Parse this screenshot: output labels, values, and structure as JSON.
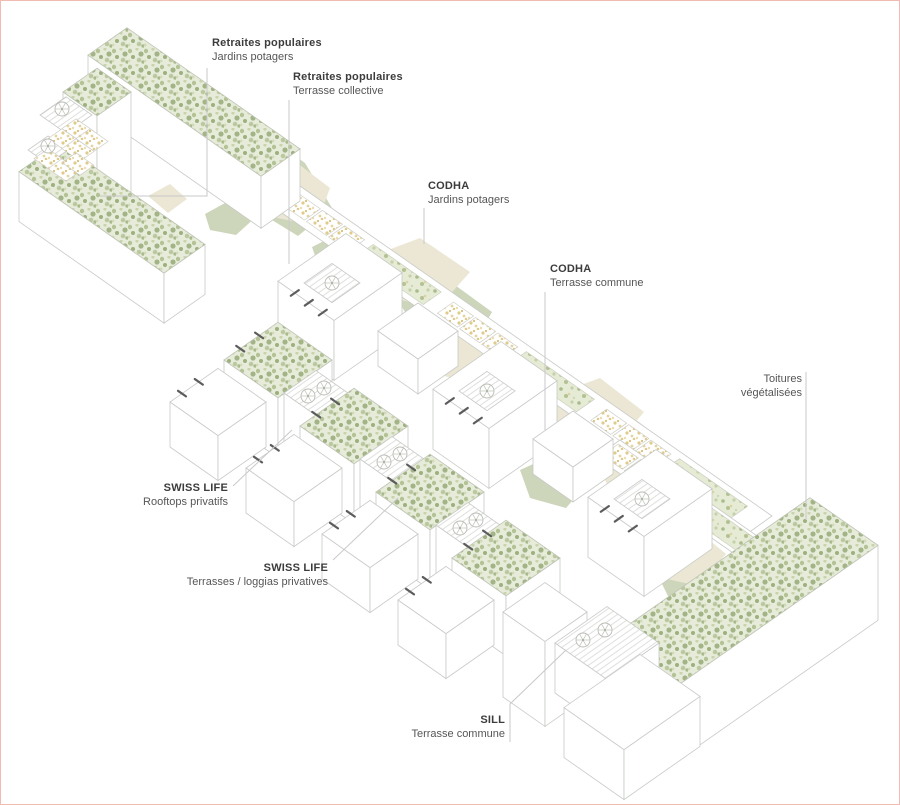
{
  "window": {
    "width": 900,
    "height": 805,
    "background": "#ffffff",
    "frame_border_color": "#f1bbb1"
  },
  "diagram": {
    "type": "axonometric-architecture-roofscape",
    "labels": {
      "retraites_jardins": {
        "title": "Retraites populaires",
        "subtitle": "Jardins potagers"
      },
      "retraites_terrasse": {
        "title": "Retraites populaires",
        "subtitle": "Terrasse collective"
      },
      "codha_jardins": {
        "title": "CODHA",
        "subtitle": "Jardins potagers"
      },
      "codha_terrasse": {
        "title": "CODHA",
        "subtitle": "Terrasse commune"
      },
      "toitures": {
        "title": "Toitures",
        "subtitle": "végétalisées"
      },
      "swiss_rooftops": {
        "title": "SWISS LIFE",
        "subtitle": "Rooftops privatifs"
      },
      "swiss_terrasses": {
        "title": "SWISS LIFE",
        "subtitle": "Terrasses / loggias privatives"
      },
      "sill": {
        "title": "SILL",
        "subtitle": "Terrasse commune"
      }
    },
    "colors": {
      "frame-border": "#f1bbb1",
      "moss-base": "#e7ecda",
      "moss-dot-1": "#a9ba8d",
      "moss-dot-2": "#c3cfa8",
      "moss-dot-3": "#93a878",
      "courtyard-green": "#cdd6ba",
      "courtyard-beige": "#ece7d4",
      "sand-dot": "#e0ca8c",
      "line": "#c7cac6",
      "tick": "#5c5c5c",
      "label-title": "#3c3c3c",
      "label-sub": "#565656",
      "leader": "#c9c9c9"
    },
    "icons": [
      "parasol-icon",
      "garden-plot-icon",
      "window-tick-icon",
      "leader-line"
    ]
  }
}
